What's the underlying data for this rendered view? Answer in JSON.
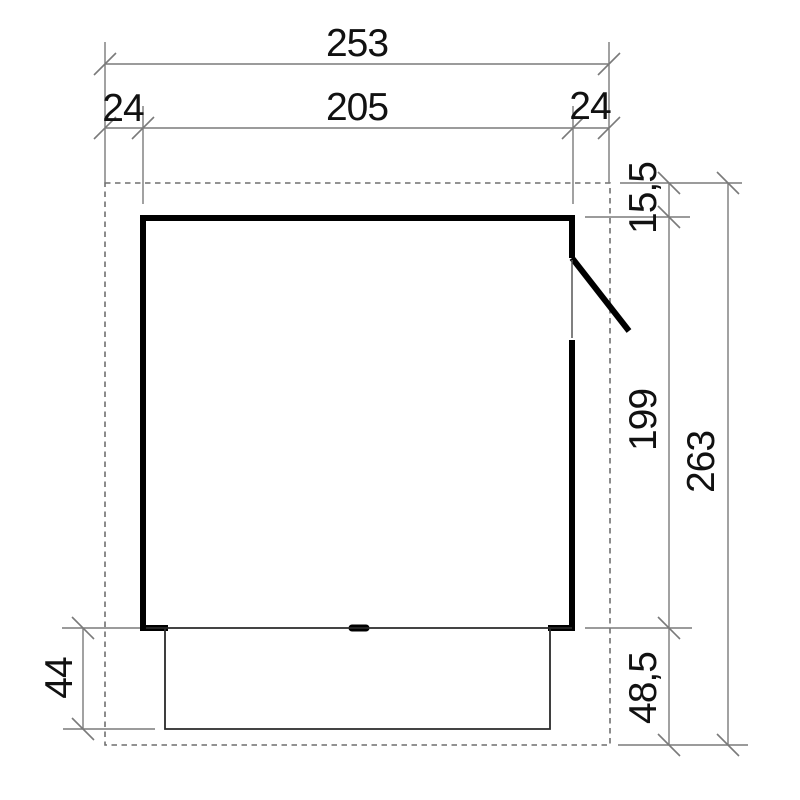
{
  "drawing": {
    "kind": "shed-floor-plan-dimension-diagram",
    "dims": {
      "total_width": "253",
      "left_overhang": "24",
      "inner_width": "205",
      "right_overhang": "24",
      "door_side_offset": "15,5",
      "inner_depth": "199",
      "total_depth": "263",
      "platform_depth_left": "44",
      "platform_depth_right": "48,5"
    },
    "colors": {
      "wall": "#000000",
      "thin_line": "#2a2a2a",
      "opening_line": "#555555",
      "dimension_line": "#7a7a7a",
      "dashed_outline": "#6f6f6f",
      "label_text": "#111111"
    }
  }
}
